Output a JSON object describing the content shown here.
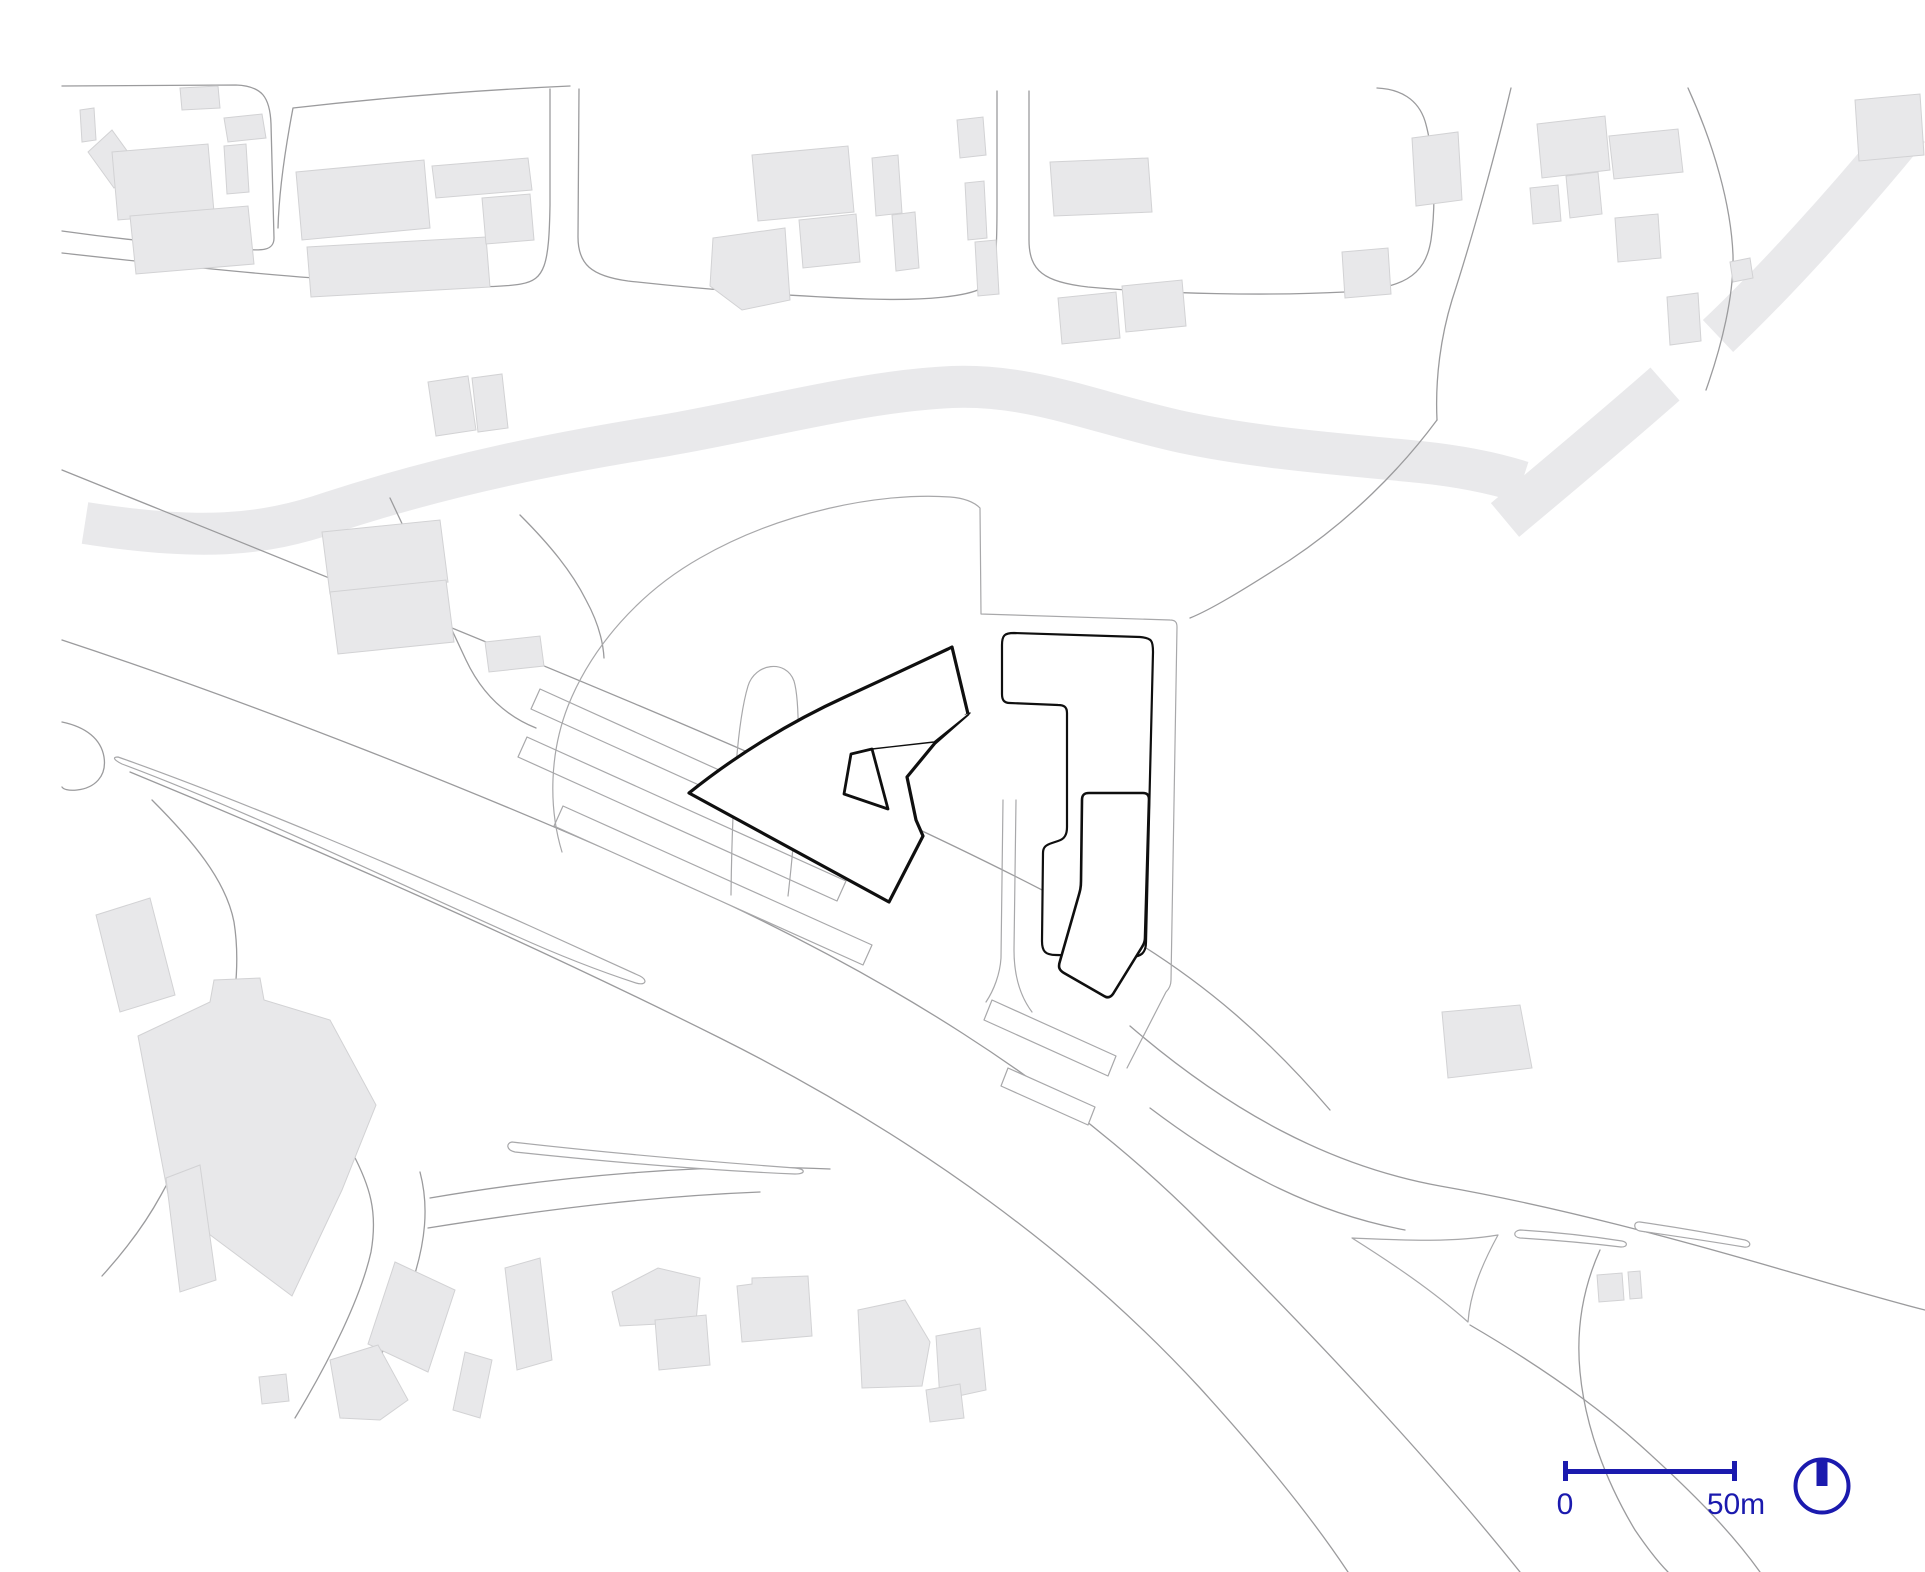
{
  "plan": {
    "kind": "architectural-site-plan",
    "scalebar": {
      "label_start": "0",
      "label_end": "50m"
    },
    "north_arrow": {
      "icon": "north-arrow-circle"
    }
  },
  "colors": {
    "background": "#ffffff",
    "context_building_fill": "#e8e8ea",
    "context_building_stroke": "#d2d2d4",
    "greenway_fill": "#e9e9eb",
    "road_stroke": "#9b9b9d",
    "parcel_stroke": "#a8a8aa",
    "site_outline": "#0f0f0f",
    "accent_blue": "#1b1aae"
  },
  "map": {
    "greenways": [
      {
        "name": "greenway-main-band",
        "d": "M85,523 C200,541 262,536 332,512 C452,473 562,452 662,436 C762,419 862,391 952,387 C1032,384 1092,412 1182,432 C1262,449 1352,455 1420,462 C1458,466 1494,473 1522,482",
        "stroke-width": "42"
      },
      {
        "name": "greenway-diagonal-lower",
        "d": "M1505,520 C1560,474 1615,428 1665,384",
        "stroke-width": "44"
      },
      {
        "name": "greenway-diagonal-upper",
        "d": "M1718,336 C1775,282 1845,205 1908,128",
        "stroke-width": "44"
      }
    ],
    "roads": [
      "M62,86 L236,85 C262,86 270,97 271,124 L274,238 C274,251 262,251 238,249 C176,245 112,238 62,231",
      "M62,253 C152,263 252,274 342,280 C432,287 492,289 521,284 C545,280 549,265 550,205 L550,89",
      "M570,86 C480,90 380,98 293,108 C285,150 279,190 278,228",
      "M579,89 L578,237 C578,264 591,276 628,281 C718,291 808,297 868,299 C928,301 968,296 982,288 C995,281 997,268 997,205 L997,91",
      "M1029,91 L1029,240 C1029,271 1044,282 1088,287 C1165,294 1268,296 1345,292 C1402,289 1425,277 1431,240 C1437,198 1433,148 1425,121 C1418,99 1400,89 1377,88",
      "M1511,88 C1494,160 1470,245 1452,300 C1441,336 1435,378 1437,420",
      "M1688,88 C1714,145 1731,205 1733,255 C1734,295 1722,345 1706,390",
      "M1437,420 C1400,470 1350,520 1290,560 C1240,592 1210,610 1190,618",
      "M62,470 C250,546 450,626 640,706 C830,786 1000,864 1120,932 C1205,982 1270,1040 1330,1110",
      "M62,640 C250,702 480,792 680,882 C880,972 1060,1082 1200,1222 C1330,1352 1440,1472 1520,1572",
      "M130,772 C300,842 520,938 720,1038 C920,1138 1080,1258 1200,1388 C1258,1452 1308,1512 1348,1572",
      "M62,722 C86,727 101,739 104,757 C107,776 95,788 77,790 C68,791 63,789 62,787",
      "M152,800 C192,840 226,880 234,922 C241,966 234,1016 221,1060 C208,1105 186,1150 161,1195 C143,1228 122,1254 102,1276",
      "M352,1152 C370,1186 378,1212 371,1252 C361,1297 330,1360 295,1418",
      "M420,1172 C429,1206 426,1242 411,1286 C396,1331 366,1386 343,1418",
      "M430,1198 C560,1176 700,1163 830,1169",
      "M428,1228 C560,1207 660,1196 760,1192",
      "M390,498 C420,562 446,618 466,660 C482,694 506,716 536,728",
      "M520,515 C550,545 572,572 586,600 C598,622 603,640 604,658",
      "M1130,1026 C1230,1112 1330,1166 1440,1186 C1560,1207 1680,1240 1790,1272 C1835,1285 1885,1300 1925,1310",
      "M1150,1108 C1240,1176 1320,1214 1405,1230",
      "M1470,1325 C1530,1360 1590,1400 1640,1445 C1690,1490 1730,1530 1760,1572",
      "M1600,1250 C1582,1290 1576,1330 1580,1372 C1585,1425 1605,1480 1635,1530 C1650,1552 1660,1564 1668,1572"
    ],
    "parcel_islands": [
      "M118,757 C240,800 400,868 530,926 C570,944 610,962 640,976 C648,980 646,986 636,983 C596,970 556,954 516,936 C380,875 240,808 122,764 C114,760 112,757 118,757 Z",
      "M512,1142 C600,1152 700,1161 795,1168 C806,1169 806,1174 795,1174 C700,1170 600,1161 515,1152 C506,1150 506,1143 512,1142 Z",
      "M540,689 L803,808 L794,828 L531,709 Z",
      "M527,737 L846,881 L837,901 L518,757 Z",
      "M563,806 L872,945 L863,965 L554,826 Z",
      "M992,1000 L1116,1056 L1108,1076 L984,1020 Z",
      "M1008,1068 L1095,1107 L1088,1125 L1001,1086 Z",
      "M1352,1238 C1400,1240 1450,1243 1498,1235 C1480,1268 1470,1295 1468,1322 C1432,1290 1390,1262 1352,1238 Z",
      "M1520,1230 C1555,1232 1590,1236 1622,1241 C1628,1242 1628,1247 1621,1247 C1588,1243 1553,1240 1520,1238 C1513,1237 1513,1231 1520,1230 Z",
      "M1640,1222 C1675,1227 1710,1233 1745,1240 C1752,1242 1751,1248 1744,1247 C1709,1241 1674,1236 1640,1231 C1633,1230 1633,1221 1640,1222 Z"
    ],
    "parcel_lines": [
      "M562,852 C548,806 550,752 568,706 C592,646 640,592 700,558 C780,512 880,492 950,497 C963,498 973,501 980,508 L981,614 L1170,620 C1175,620 1177,622 1177,627 L1171,980 C1171,985 1169,989 1166,992 L1127,1068",
      "M731,895 C732,812 736,726 748,686 C755,663 786,659 794,681 C800,701 799,751 796,806 C794,841 791,870 788,896",
      "M1003,800 L1001,958 C1000,974 994,990 986,1002",
      "M1016,800 L1014,950 C1014,976 1020,996 1032,1012"
    ],
    "context_buildings": [
      "M88,152 L112,130 L138,166 L114,188 Z",
      "M80,110 L94,108 L96,140 L82,142 Z",
      "M112,152 L208,144 L214,212 L118,220 Z",
      "M130,216 L248,206 L254,264 L136,274 Z",
      "M224,118 L262,114 L266,138 L228,142 Z",
      "M224,146 L246,144 L249,192 L227,194 Z",
      "M180,88 L218,86 L220,108 L182,110 Z",
      "M296,172 L424,160 L430,228 L302,240 Z",
      "M307,247 L486,237 L490,287 L311,297 Z",
      "M432,166 L528,158 L532,190 L436,198 Z",
      "M482,198 L530,194 L534,240 L486,244 Z",
      "M428,382 L468,376 L476,430 L436,436 Z",
      "M472,378 L502,374 L508,428 L478,432 Z",
      "M752,155 L848,146 L854,212 L758,221 Z",
      "M713,238 L785,228 L790,300 L742,310 L710,286 Z",
      "M799,220 L856,214 L860,262 L803,268 Z",
      "M872,158 L898,155 L902,213 L876,216 Z",
      "M892,215 L915,212 L919,268 L896,271 Z",
      "M957,120 L983,117 L986,155 L960,158 Z",
      "M965,183 L984,181 L987,238 L968,240 Z",
      "M975,242 L996,240 L999,294 L978,296 Z",
      "M1050,162 L1148,158 L1152,212 L1054,216 Z",
      "M1058,298 L1116,292 L1120,338 L1062,344 Z",
      "M1122,286 L1182,280 L1186,326 L1126,332 Z",
      "M1342,252 L1388,248 L1391,294 L1345,298 Z",
      "M1412,138 L1458,132 L1462,200 L1416,206 Z",
      "M1537,124 L1605,116 L1610,170 L1542,178 Z",
      "M1530,188 L1558,185 L1561,221 L1533,224 Z",
      "M1566,176 L1598,172 L1602,214 L1570,218 Z",
      "M1609,136 L1678,129 L1683,172 L1614,179 Z",
      "M1615,218 L1658,214 L1661,258 L1618,262 Z",
      "M1667,297 L1698,293 L1701,341 L1670,345 Z",
      "M1730,262 L1750,258 L1753,278 L1733,282 Z",
      "M1855,100 L1920,94 L1924,155 L1859,161 Z",
      "M322,532 L440,520 L448,582 L330,594 Z",
      "M330,592 L446,580 L454,642 L338,654 Z",
      "M485,642 L540,636 L544,666 L489,672 Z",
      "M1442,1012 L1520,1005 L1532,1068 L1448,1078 Z",
      "M96,915 L150,898 L175,995 L120,1012 Z",
      "M138,1036 L210,1002 L214,980 L260,978 L264,1000 L330,1020 L376,1105 L342,1190 L292,1296 L170,1205 Z",
      "M166,1178 L200,1165 L216,1280 L180,1292 Z",
      "M259,1377 L286,1374 L289,1401 L262,1404 Z",
      "M395,1262 L455,1290 L428,1372 L368,1344 Z",
      "M330,1360 L378,1345 L408,1400 L380,1420 L340,1418 Z",
      "M465,1352 L492,1360 L480,1418 L453,1410 Z",
      "M505,1268 L540,1258 L552,1360 L517,1370 Z",
      "M612,1292 L658,1268 L700,1278 L696,1322 L620,1326 Z",
      "M655,1320 L706,1315 L710,1365 L659,1370 Z",
      "M737,1286 L752,1284 L752,1278 L808,1276 L812,1336 L742,1342 Z",
      "M858,1310 L905,1300 L930,1342 L922,1386 L862,1388 Z",
      "M936,1336 L980,1328 L986,1390 L940,1400 Z",
      "M926,1390 L960,1384 L964,1418 L930,1422 Z",
      "M1597,1275 L1622,1273 L1624,1300 L1599,1302 Z",
      "M1628,1272 L1640,1271 L1642,1298 L1630,1299 Z"
    ],
    "site_buildings": [
      {
        "name": "site-main-building",
        "d": "M689,793 C735,756 790,722 845,697 C880,681 920,662 948,649 L952,647 L968,714 L935,743 L907,777 L916,820 L923,836 L889,902 Z"
      },
      {
        "name": "site-l-building",
        "d": "M1014,633 L1140,637 C1152,638 1153,641 1153,652 L1146,942 C1146,953 1141,957 1130,957 L1056,955 C1045,955 1042,951 1042,941 L1043,853 C1043,847 1046,845 1052,843 L1058,841 C1065,839 1067,834 1067,827 L1067,713 C1067,707 1064,705 1058,705 L1010,703 C1004,703 1002,700 1002,694 L1002,645 C1002,635 1005,633 1014,633 Z"
      },
      {
        "name": "site-tower-building",
        "d": "M1089,793 L1143,793 C1147,793 1149,795 1149,799 L1145,938 C1145,941 1144,944 1142,947 L1113,994 C1110,998 1107,998 1104,996 L1064,973 C1059,970 1058,967 1060,961 L1078,898 C1080,891 1081,888 1081,881 L1082,800 C1082,795 1084,793 1089,793 Z"
      },
      {
        "name": "site-inner-pavilion",
        "d": "M851,754 L872,749 L888,809 L844,794 Z"
      },
      {
        "name": "site-link-line",
        "d": "M872,749 L934,742 L970,713"
      }
    ]
  }
}
